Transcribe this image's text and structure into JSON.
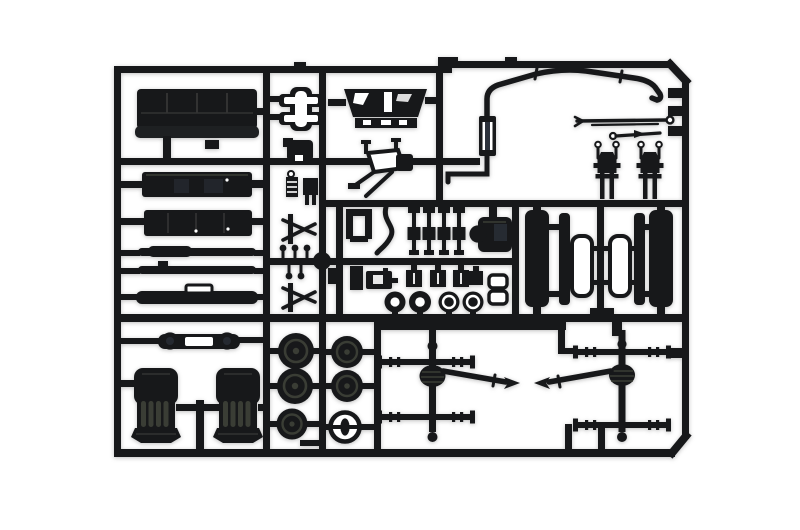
{
  "scene": {
    "alt": "Black plastic injection-molded model kit sprue (runner frame) holding truck model parts on a white background",
    "background": "#ffffff"
  },
  "colors": {
    "white": "#ffffff",
    "plastic": "#17181a",
    "plastic_soft": "#1e2022",
    "highlight": "#3a3d35",
    "seam": "#323232",
    "sheen": "#2c313b",
    "shadow": "rgba(70,70,70,0.35)"
  },
  "parts": {
    "frame": "sprue-frame",
    "bench_seat": "bench-seat",
    "fuel_tank": "fuel-tank",
    "storage_box": "storage-box",
    "tie_rod_1": "tie-rod",
    "tie_rod_2": "drive-rod",
    "side_muffler": "side-muffler",
    "bumper": "front-bumper-panel",
    "seat_left": "driver-seat",
    "seat_right": "passenger-seat",
    "wheels": "road-wheels",
    "steering_wheel": "steering-wheel",
    "axle_front": "front-axle-assembly",
    "axle_rear": "rear-axle-assembly",
    "exhaust": "exhaust-pipe-with-muffler",
    "dashboard": "dashboard-panel",
    "cross_brace": "cross-brace",
    "linkage": "pedal-linkage",
    "shocks": "shock-absorbers",
    "engine": "gearbox-block",
    "hubs": "wheel-hubs",
    "spring_hangers": "spring-hangers",
    "leaf_panels": "leaf-spring-panels",
    "control_rods": "control-rods"
  }
}
